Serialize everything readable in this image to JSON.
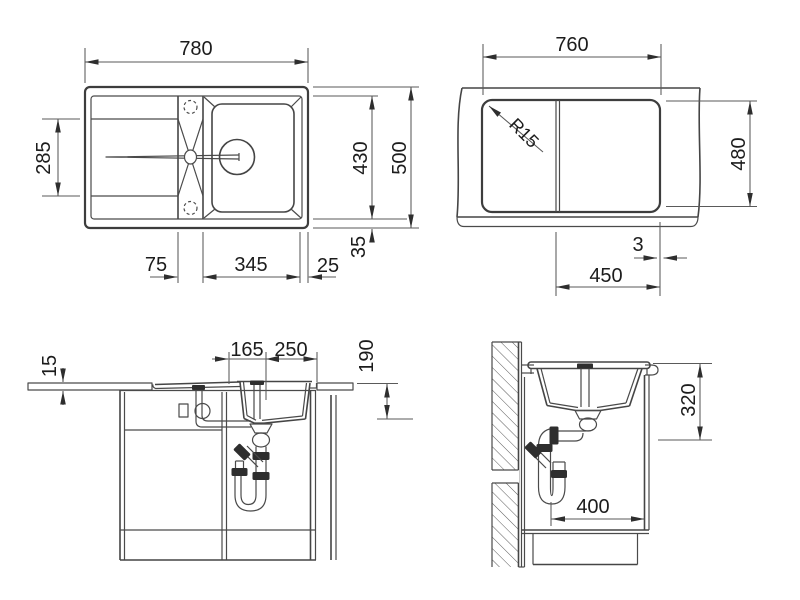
{
  "drawing": {
    "type": "sink-installation-technical-drawing",
    "background": "#ffffff",
    "line_color": "#454545",
    "text_color": "#1c1c1c",
    "plan": {
      "w780": "780",
      "d285": "285",
      "d430": "430",
      "d500": "500",
      "d35": "35",
      "d75": "75",
      "d345": "345",
      "d25": "25"
    },
    "cut": {
      "w760": "760",
      "r15": "R15",
      "d480": "480",
      "d3": "3",
      "d450": "450"
    },
    "front": {
      "d15": "15",
      "d165": "165",
      "d250": "250",
      "d190": "190"
    },
    "side": {
      "d320": "320",
      "d400": "400"
    }
  }
}
